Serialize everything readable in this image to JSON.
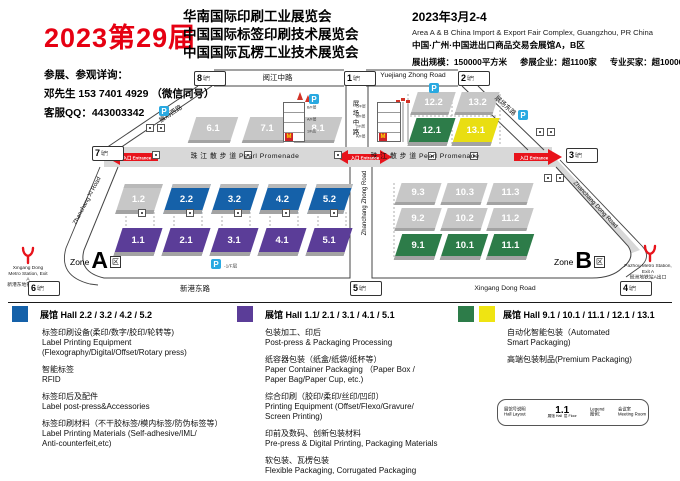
{
  "header": {
    "edition": "2023第29届",
    "titles": [
      "华南国际印刷工业展览会",
      "中国国际标签印刷技术展览会",
      "中国国际瓦楞工业技术展览会"
    ],
    "date": "2023年3月2-4",
    "venue_en": "Area A & B China Import & Export Fair Complex, Guangzhou, PR China",
    "venue_cn": "中国·广州·中国进出口商品交易会展馆A，B区",
    "stats": [
      "展出规模：150000平方米",
      "参展企业：超1100家",
      "专业买家：超100000人"
    ]
  },
  "contact": {
    "line1": "参展、参观详询：",
    "line2": "邓先生 153 7401 4929 （微信同号）",
    "line3": "客服QQ：443003342"
  },
  "map": {
    "entrance": "入口 Entrance",
    "parking": "P",
    "parking_floor": "-1/F层",
    "mcdonalds": "M",
    "gate_word": "Gate",
    "gate_cn": "号门",
    "gates": [
      {
        "n": "8"
      },
      {
        "n": "1"
      },
      {
        "n": "2"
      },
      {
        "n": "7"
      },
      {
        "n": "3"
      },
      {
        "n": "6"
      },
      {
        "n": "5"
      },
      {
        "n": "4"
      }
    ],
    "zones": {
      "word": "Zone",
      "a": "A",
      "b": "B",
      "qu": "区"
    },
    "roads": {
      "yuejiang_cn": "阅江中路",
      "yuejiang_en": "Yuejiang Zhong Road",
      "promenade": "珠 江 散 步 道 Pearl Promenade",
      "xingang_cn": "新港东路",
      "xingang_en": "Xingang Dong Road",
      "center_cn": "展场中路",
      "center_en": "Zhanchang Zhong Road",
      "west_cn": "展场西路",
      "west_en": "Zhanchang Xi Road",
      "east_cn": "展场东路",
      "east_en": "Zhanchang Dong Road"
    },
    "halls": [
      {
        "label": "6.1",
        "color": "gray"
      },
      {
        "label": "7.1",
        "color": "gray"
      },
      {
        "label": "8.1",
        "color": "gray"
      },
      {
        "label": "12.2",
        "color": "gray"
      },
      {
        "label": "13.2",
        "color": "gray"
      },
      {
        "label": "12.1",
        "color": "green"
      },
      {
        "label": "13.1",
        "color": "yellow"
      },
      {
        "label": "1.2",
        "color": "gray"
      },
      {
        "label": "2.2",
        "color": "blue"
      },
      {
        "label": "3.2",
        "color": "blue"
      },
      {
        "label": "4.2",
        "color": "blue"
      },
      {
        "label": "5.2",
        "color": "blue"
      },
      {
        "label": "1.1",
        "color": "purple"
      },
      {
        "label": "2.1",
        "color": "purple"
      },
      {
        "label": "3.1",
        "color": "purple"
      },
      {
        "label": "4.1",
        "color": "purple"
      },
      {
        "label": "5.1",
        "color": "purple"
      },
      {
        "label": "9.3",
        "color": "gray"
      },
      {
        "label": "10.3",
        "color": "gray"
      },
      {
        "label": "11.3",
        "color": "gray"
      },
      {
        "label": "9.2",
        "color": "gray"
      },
      {
        "label": "10.2",
        "color": "gray"
      },
      {
        "label": "11.2",
        "color": "gray"
      },
      {
        "label": "9.1",
        "color": "green"
      },
      {
        "label": "10.1",
        "color": "green"
      },
      {
        "label": "11.1",
        "color": "green"
      }
    ],
    "buildings": {
      "left_floors": [
        "B/F层",
        "A/F层",
        "1/F层"
      ],
      "right_floors": [
        "C/F层",
        "B/F层",
        "2/F层",
        "A/F层"
      ]
    },
    "metro": {
      "left_en": "Xingang Dong Metro Station, Exit A",
      "left_cn": "新港东地铁站A出口",
      "right_en": "Pazhou Metro Station, Exit A",
      "right_cn": "琶洲地铁站A出口"
    }
  },
  "legend": {
    "columns": [
      {
        "color": "#1561a9",
        "title": "展馆 Hall 2.2 / 3.2 / 4.2 / 5.2",
        "items": [
          [
            "标签印刷设备(柔印/数字/胶印/轮转等)",
            "Label Printing Equipment",
            " (Flexography/Digital/Offset/Rotary press)"
          ],
          [
            "智能标签",
            "RFID"
          ],
          [
            "标签印后及配件",
            "Label post-press&Accessories"
          ],
          [
            "标签印刷材料（不干胶标签/模内标签/防伪标签等）",
            "Label Printing Materials (Self-adhesive/IML/",
            "Anti-counterfeit,etc)"
          ]
        ]
      },
      {
        "color": "#5b3d98",
        "title": "展馆 Hall 1.1/ 2.1 / 3.1 / 4.1 / 5.1",
        "items": [
          [
            "包装加工、印后",
            "Post-press & Packaging Processing"
          ],
          [
            "纸容器包装（纸盒/纸袋/纸杯等）",
            "Paper Container Packaging （Paper Box /",
            "Paper Bag/Paper Cup, etc.)"
          ],
          [
            "综合印刷（胶印/柔印/丝印/凹印）",
            "Printing Equipment (Offset/Flexo/Gravure/",
            "Screen Printing)"
          ],
          [
            "印前及数码、创新包装材料",
            "Pre-press & Digital Printing, Packaging Materials"
          ],
          [
            "软包装、瓦楞包装",
            "Flexible Packaging, Corrugated Packaging"
          ]
        ]
      },
      {
        "color": "#2d7c49",
        "color2": "#efe412",
        "title": "展馆 Hall 9.1 / 10.1 / 11.1 / 12.1 / 13.1",
        "items": [
          [
            "自动化智能包装（Automated",
            "Smart Packaging)"
          ],
          [
            "高端包装制品(Premium Packaging)"
          ]
        ]
      }
    ]
  },
  "mini_legend": {
    "layout_cn": "展馆号说明",
    "layout_en": "Hall Layout",
    "sample": "1.1",
    "hall_cn": "展馆",
    "hall_en": "Hall",
    "floor_cn": "层",
    "floor_en": "Floor",
    "legend_en": "Legend",
    "legend_cn": "图例：",
    "meeting_cn": "会议室",
    "meeting_en": "Meeting Room"
  },
  "colors": {
    "red": "#e60012",
    "blue": "#1561a9",
    "purple": "#5b3d98",
    "green": "#2d7c49",
    "yellow": "#efe412",
    "hall_gray": "#c7c7c7",
    "road_gray": "#d8d8d8",
    "parking_blue": "#29a9e1"
  }
}
